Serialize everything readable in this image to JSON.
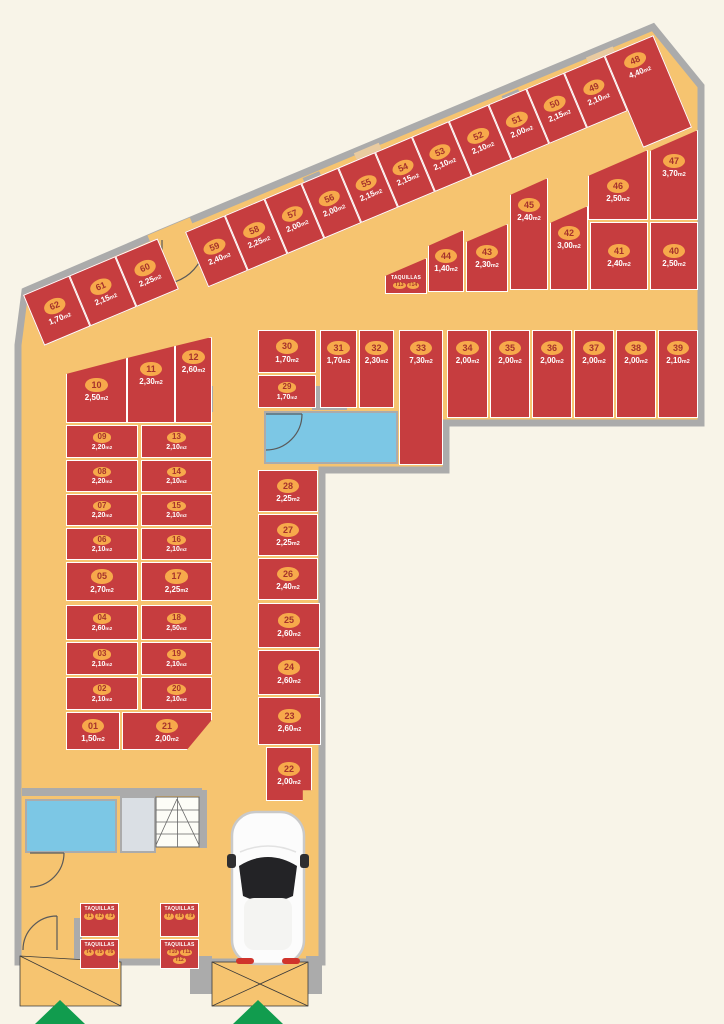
{
  "plan": {
    "area_unit": "m2",
    "units": [
      {
        "id": "01",
        "area": "1,50"
      },
      {
        "id": "02",
        "area": "2,10"
      },
      {
        "id": "03",
        "area": "2,10"
      },
      {
        "id": "04",
        "area": "2,60"
      },
      {
        "id": "05",
        "area": "2,70"
      },
      {
        "id": "06",
        "area": "2,10"
      },
      {
        "id": "07",
        "area": "2,20"
      },
      {
        "id": "08",
        "area": "2,20"
      },
      {
        "id": "09",
        "area": "2,20"
      },
      {
        "id": "10",
        "area": "2,50"
      },
      {
        "id": "11",
        "area": "2,30"
      },
      {
        "id": "12",
        "area": "2,60"
      },
      {
        "id": "13",
        "area": "2,10"
      },
      {
        "id": "14",
        "area": "2,10"
      },
      {
        "id": "15",
        "area": "2,10"
      },
      {
        "id": "16",
        "area": "2,10"
      },
      {
        "id": "17",
        "area": "2,25"
      },
      {
        "id": "18",
        "area": "2,50"
      },
      {
        "id": "19",
        "area": "2,10"
      },
      {
        "id": "20",
        "area": "2,10"
      },
      {
        "id": "21",
        "area": "2,00"
      },
      {
        "id": "22",
        "area": "2,00"
      },
      {
        "id": "23",
        "area": "2,60"
      },
      {
        "id": "24",
        "area": "2,60"
      },
      {
        "id": "25",
        "area": "2,60"
      },
      {
        "id": "26",
        "area": "2,40"
      },
      {
        "id": "27",
        "area": "2,25"
      },
      {
        "id": "28",
        "area": "2,25"
      },
      {
        "id": "29",
        "area": "1,70"
      },
      {
        "id": "30",
        "area": "1,70"
      },
      {
        "id": "31",
        "area": "1,70"
      },
      {
        "id": "32",
        "area": "2,30"
      },
      {
        "id": "33",
        "area": "7,30"
      },
      {
        "id": "34",
        "area": "2,00"
      },
      {
        "id": "35",
        "area": "2,00"
      },
      {
        "id": "36",
        "area": "2,00"
      },
      {
        "id": "37",
        "area": "2,00"
      },
      {
        "id": "38",
        "area": "2,00"
      },
      {
        "id": "39",
        "area": "2,10"
      },
      {
        "id": "40",
        "area": "2,50"
      },
      {
        "id": "41",
        "area": "2,40"
      },
      {
        "id": "42",
        "area": "3,00"
      },
      {
        "id": "43",
        "area": "2,30"
      },
      {
        "id": "44",
        "area": "1,40"
      },
      {
        "id": "45",
        "area": "2,40"
      },
      {
        "id": "46",
        "area": "2,50"
      },
      {
        "id": "47",
        "area": "3,70"
      },
      {
        "id": "48",
        "area": "4,40"
      },
      {
        "id": "49",
        "area": "2,10"
      },
      {
        "id": "50",
        "area": "2,15"
      },
      {
        "id": "51",
        "area": "2,00"
      },
      {
        "id": "52",
        "area": "2,10"
      },
      {
        "id": "53",
        "area": "2,10"
      },
      {
        "id": "54",
        "area": "2,15"
      },
      {
        "id": "55",
        "area": "2,15"
      },
      {
        "id": "56",
        "area": "2,00"
      },
      {
        "id": "57",
        "area": "2,00"
      },
      {
        "id": "58",
        "area": "2,25"
      },
      {
        "id": "59",
        "area": "2,40"
      },
      {
        "id": "60",
        "area": "2,25"
      },
      {
        "id": "61",
        "area": "2,15"
      },
      {
        "id": "62",
        "area": "1,70"
      }
    ],
    "taquillas": {
      "mid": {
        "label": "TAQUILLAS",
        "tags": [
          "T13",
          "T14"
        ]
      },
      "bottom": [
        {
          "label": "TAQUILLAS",
          "tags": [
            "T1",
            "T2",
            "T3"
          ]
        },
        {
          "label": "TAQUILLAS",
          "tags": [
            "T4",
            "T5",
            "T6"
          ]
        },
        {
          "label": "TAQUILLAS",
          "tags": [
            "T7",
            "T8",
            "T9"
          ]
        },
        {
          "label": "TAQUILLAS",
          "tags": [
            "T10",
            "T11",
            "T12"
          ]
        }
      ]
    },
    "colors": {
      "unit_red": "#C63D3F",
      "floor_orange": "#F6C470",
      "wall_gray": "#ABABAB",
      "badge_orange": "#F7A94B",
      "badge_text": "#A5322C",
      "background": "#F8F4E8",
      "water_blue": "#7CC7E5",
      "arrow_green": "#119C4E"
    }
  }
}
